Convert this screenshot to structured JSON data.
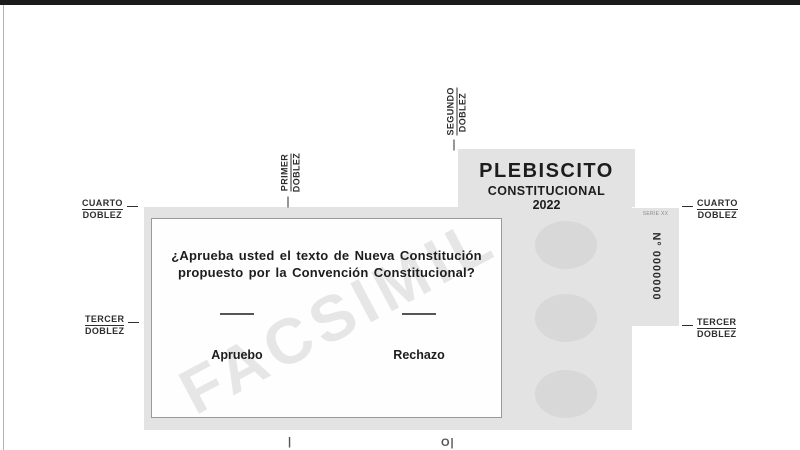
{
  "header": {
    "title": "PLEBISCITO",
    "subtitle": "CONSTITUCIONAL",
    "year": "2022"
  },
  "ballot": {
    "watermark": "FACSIMIL",
    "question": {
      "line1": "¿Aprueba usted el texto de Nueva Constitución",
      "line2": "propuesto por la Convención Constitucional?"
    },
    "options": [
      {
        "label": "Apruebo"
      },
      {
        "label": "Rechazo"
      }
    ]
  },
  "serial": {
    "series": "SERIE XX",
    "number": "N° 0000000"
  },
  "folds": {
    "primer": {
      "w1": "PRIMER",
      "w2": "DOBLEZ"
    },
    "segundo": {
      "w1": "SEGUNDO",
      "w2": "DOBLEZ"
    },
    "tercer": {
      "w1": "TERCER",
      "w2": "DOBLEZ"
    },
    "cuarto": {
      "w1": "CUARTO",
      "w2": "DOBLEZ"
    }
  },
  "edge_marks": {
    "left": "|",
    "right": "O|"
  },
  "colors": {
    "paper_gray": "#e3e3e3",
    "oval_gray": "#d8d8d8",
    "ink": "#1d1d1d",
    "frame_bar": "#1b1b1b"
  }
}
